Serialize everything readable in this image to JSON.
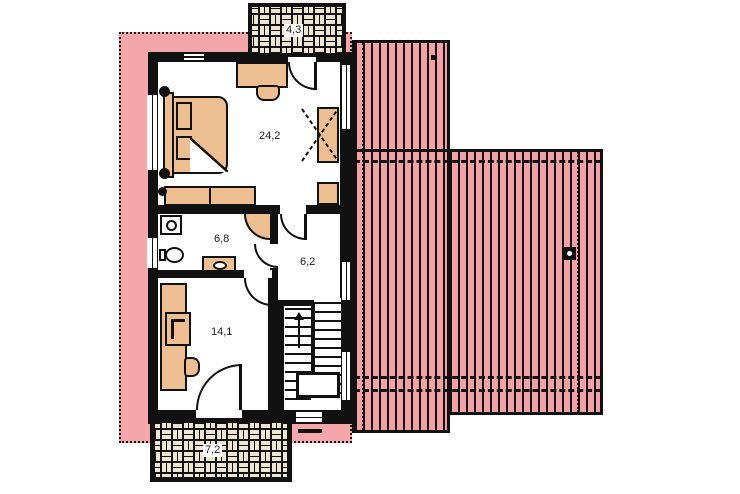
{
  "plan": {
    "rooms": [
      {
        "id": "bedroom",
        "area_label": "24,2"
      },
      {
        "id": "bathroom",
        "area_label": "6,8"
      },
      {
        "id": "hallway",
        "area_label": "6,2"
      },
      {
        "id": "room",
        "area_label": "14,1"
      },
      {
        "id": "terrace",
        "area_label": "7,2"
      },
      {
        "id": "chimney-balcony",
        "area_label": "4,3"
      }
    ],
    "colors": {
      "roof_overhang_pink": "#F4A6AB",
      "roof_stripe_pink": "#F2A1A7",
      "furniture_tan": "#EDBE92",
      "wall_black": "#111111",
      "brick_beige": "#EDE6D4",
      "floor_white": "#FFFFFF"
    }
  }
}
